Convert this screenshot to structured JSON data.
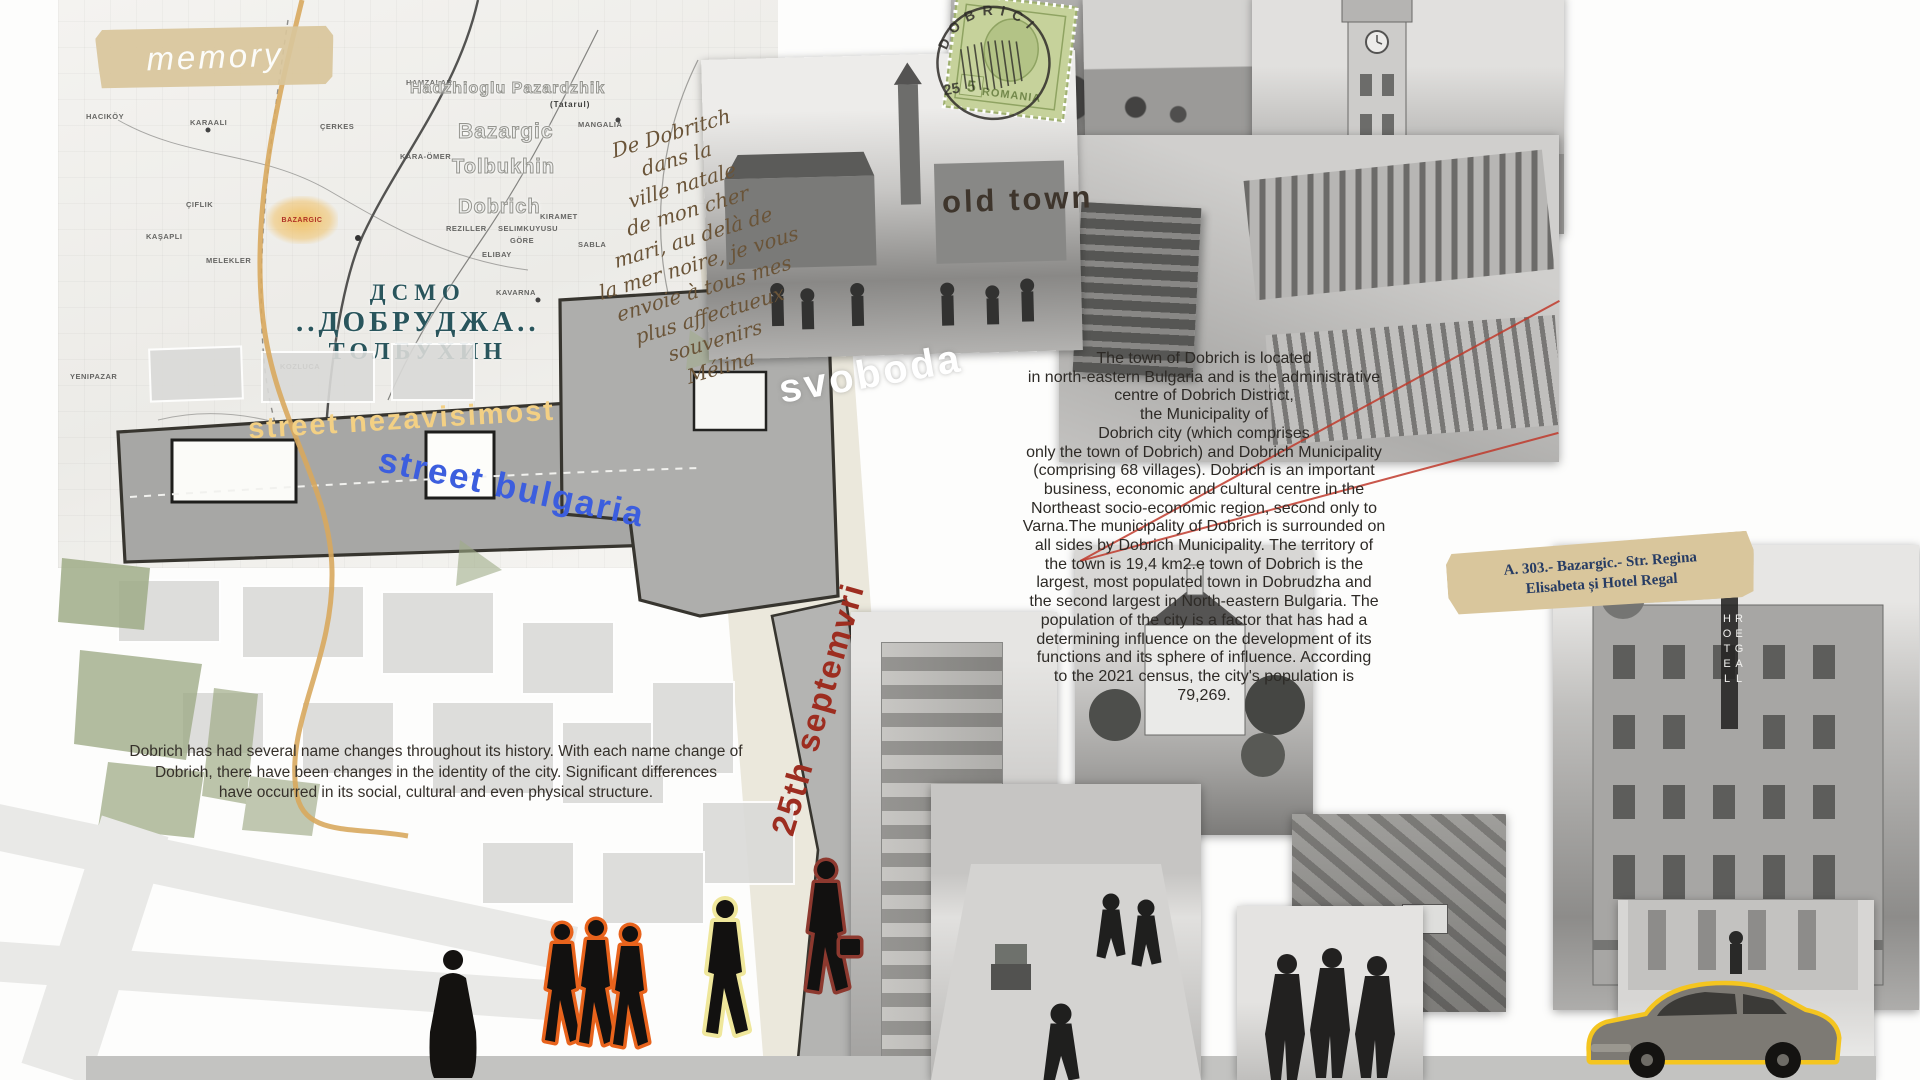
{
  "poster": {
    "memory_label": "memory",
    "old_town_label": "old town",
    "street_labels": {
      "nezavisimost": "street nezavisimost",
      "bulgaria": "street bulgaria",
      "svoboda": "svoboda",
      "septemvri": "25th septemvri"
    },
    "map_title": {
      "line1": "ДСМО",
      "line2": "..ДОБРУДЖА..",
      "line3": "ТОЛБУХИН"
    },
    "historic_names": {
      "n1": "Hadzhioglu Pazardzhik",
      "n1_sub": "(Tatarul)",
      "n2": "Bazargic",
      "n3": "Tolbukhin",
      "n4": "Dobrich"
    },
    "map_highlight_label": "BAZARGIC",
    "map_place_labels": [
      "Kavarna",
      "Kozluca",
      "Mangalia",
      "Sabla",
      "Yenipazar",
      "Hamzalar",
      "Kara-Ömer",
      "Çiflik",
      "Kaşapli",
      "Melekler",
      "Reziller",
      "Selimkuyusu",
      "Elibay",
      "Göre",
      "Kiramet",
      "Haciköy",
      "Karaali",
      "Çerkes"
    ],
    "postcard_note": "De Dobritch\ndans la\nville natale\nde mon cher\nmari, au delà de\nla mer noire, je vous\nenvoie à tous mes\nplus affectueux\nsouvenirs\nMélina",
    "stamp": {
      "country": "ROMANIA",
      "value": "5",
      "postmark_town": "DOBRICI",
      "postmark_number": "25"
    },
    "photo_captions": {
      "fountain": "Шадравана",
      "hotel_sign": "HOTEL REGAL"
    },
    "ticket_label": "A. 303.- Bazargic.- Str. Regina\nElisabeta și Hotel Regal",
    "about_text": "The town of Dobrich is located\nin north-eastern Bulgaria and is the administrative\ncentre of Dobrich District,\nthe Municipality of\nDobrich city (which comprises\nonly the town of Dobrich) and Dobrich Municipality\n(comprising 68 villages). Dobrich is an important\nbusiness, economic and cultural centre in the\nNortheast socio-economic region, second only to\nVarna.The municipality of Dobrich is surrounded on\nall sides by Dobrich Municipality. The territory of\nthe town is 19,4 km2.e town of Dobrich is the\nlargest, most populated town in Dobrudzha and\nthe second largest in North-eastern Bulgaria. The\npopulation of the city is a factor that has had a\ndetermining influence on the development of its\nfunctions and its sphere of influence. According\nto the 2021 census, the city's population is\n79,269.",
    "history_text": "Dobrich  has had several name changes throughout its history. With each name change of\nDobrich, there have been changes in the identity of the city. Significant differences\nhave occurred in its social, cultural and even physical structure.",
    "colors": {
      "street_yellow": "#f3d084",
      "street_blue": "#3c5ede",
      "septemvri_red": "#9d2d20",
      "title_teal": "#29555c",
      "tape_tan": "#d9c69c",
      "outline_orange": "#e8631c",
      "outline_yellow": "#efe79b",
      "outline_darkred": "#8d392f",
      "car_outline_yellow": "#f4c520",
      "annotation_red": "#c0392b"
    }
  }
}
